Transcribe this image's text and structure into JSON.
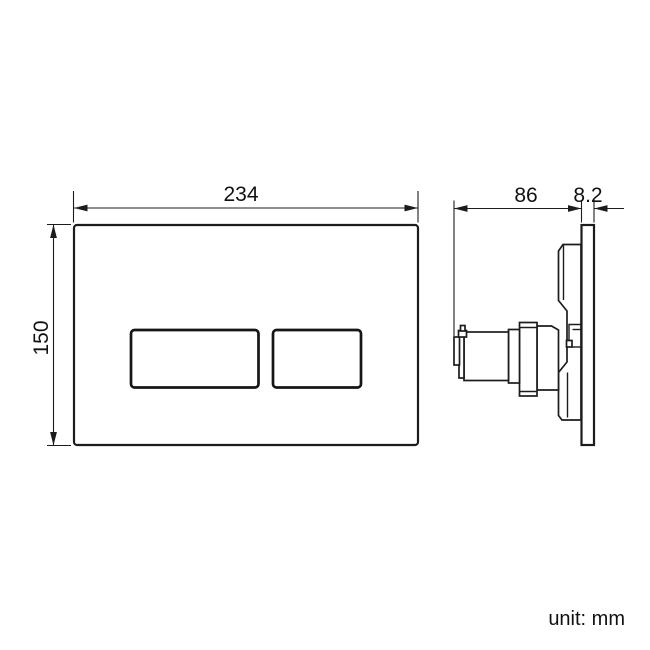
{
  "drawing": {
    "front_view": {
      "width_mm": "234",
      "height_mm": "150"
    },
    "side_view": {
      "depth_mm": "86",
      "plate_thickness_mm": "8.2"
    },
    "unit_note": "unit: mm"
  },
  "colors": {
    "line": "#1c1c1c",
    "background": "#ffffff"
  }
}
